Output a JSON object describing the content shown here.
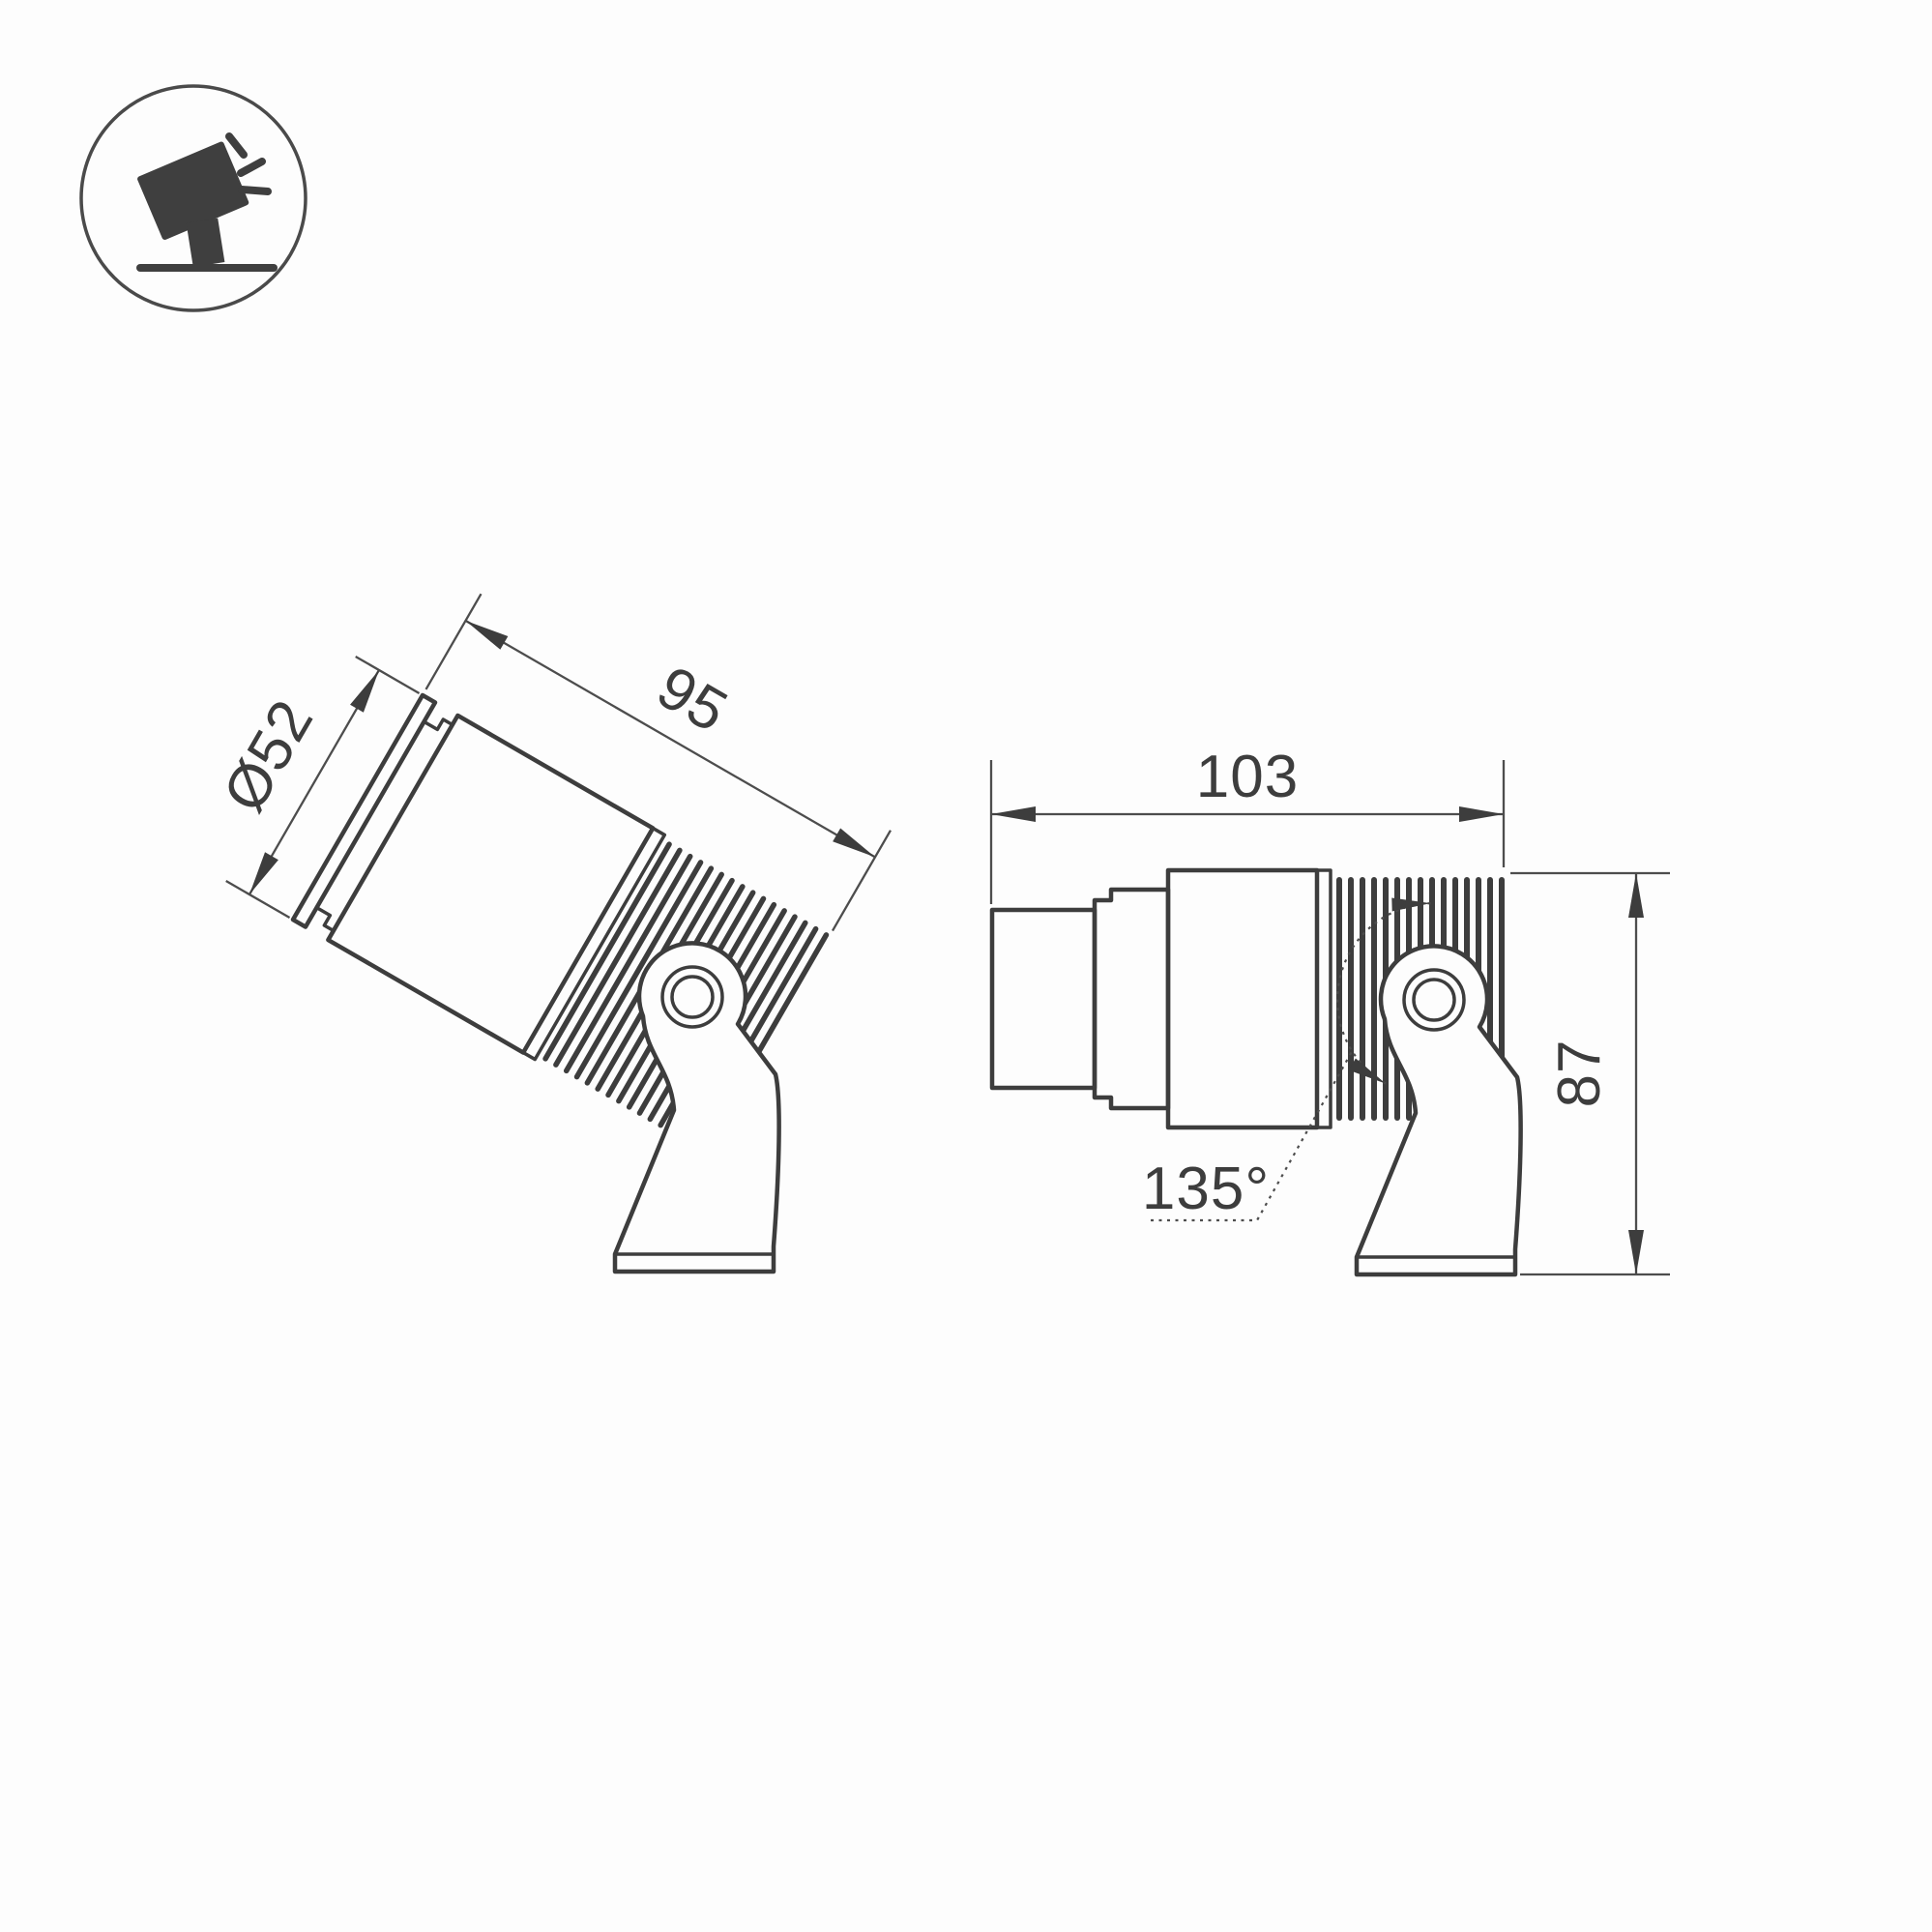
{
  "drawing": {
    "type": "technical-dimension-drawing",
    "subject": "adjustable spotlight luminaire on pivot bracket, two projection views",
    "colors": {
      "background": "#fdfdfd",
      "line": "#3d3d3d",
      "dim_line": "#4d4d4d",
      "text": "#3d3d3d"
    }
  },
  "icon": {
    "name": "tilted-spotlight-on-stand-pictogram"
  },
  "views": {
    "tilted": {
      "name": "tilted-view",
      "diameter_label": "Ø52",
      "length_label": "95"
    },
    "side": {
      "name": "side-view",
      "length_label": "103",
      "height_label": "87",
      "rotation_label": "135°"
    }
  }
}
